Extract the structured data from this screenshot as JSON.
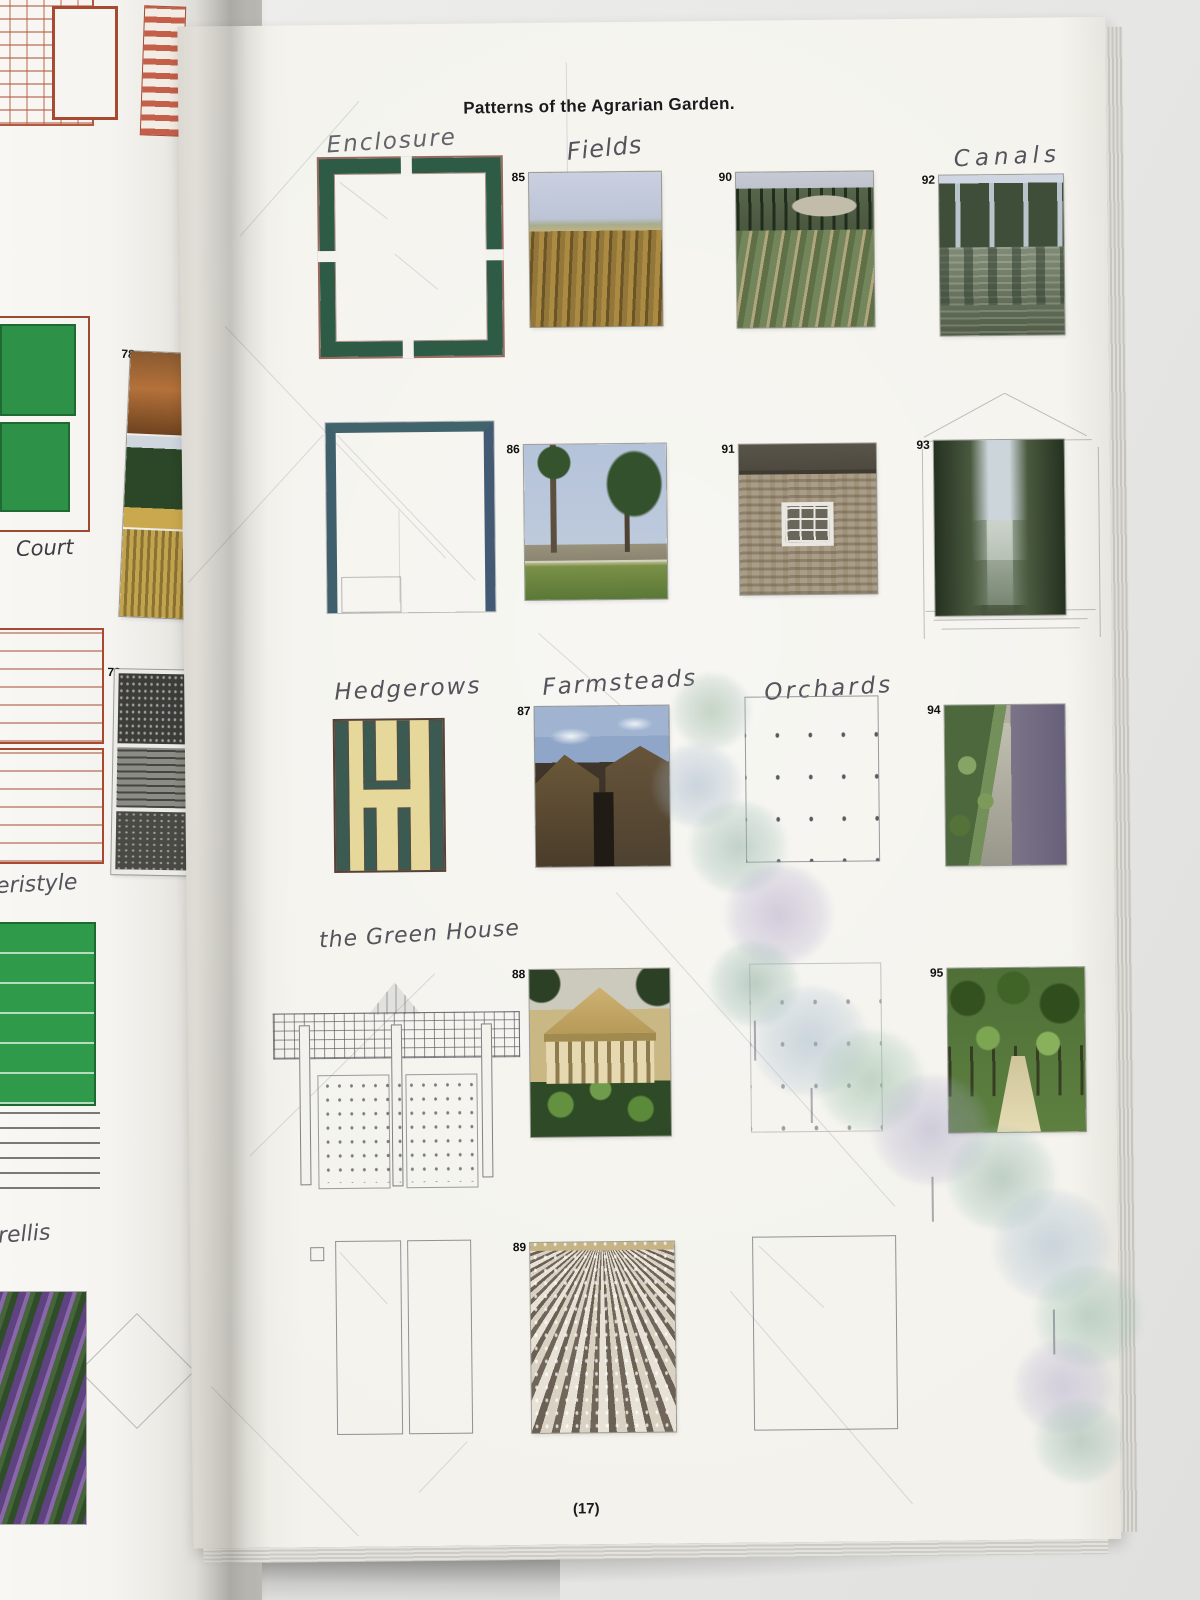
{
  "book": {
    "title": "Patterns of the Agrarian Garden.",
    "page_number": "(17)"
  },
  "left_page": {
    "labels": {
      "court": "Court",
      "peristyle": "eristyle",
      "trellis": "rellis"
    },
    "figures": [
      {
        "number": "78",
        "subject": "farm buildings, trees and wheat field"
      },
      {
        "number": "79",
        "subject": "engraving of trees and farm buildings"
      }
    ]
  },
  "right_page": {
    "section_labels": {
      "enclosure": "Enclosure",
      "fields": "Fields",
      "canals": "Canals",
      "hedgerows": "Hedgerows",
      "farmsteads": "Farmsteads",
      "orchards": "Orchards",
      "greenhouse": "the Green House"
    },
    "photos": [
      {
        "number": "85",
        "subject": "ripe crop field under hazy sky"
      },
      {
        "number": "90",
        "subject": "villa farmland with cypress trees"
      },
      {
        "number": "92",
        "subject": "canal water with tree reflections"
      },
      {
        "number": "86",
        "subject": "young poplars in front of farm fields"
      },
      {
        "number": "91",
        "subject": "stone farmhouse wall with window"
      },
      {
        "number": "93",
        "subject": "tree-lined canal vista"
      },
      {
        "number": "87",
        "subject": "stone farmstead buildings"
      },
      {
        "number": "94",
        "subject": "water channel beside garden wall"
      },
      {
        "number": "88",
        "subject": "classical villa portico behind crops"
      },
      {
        "number": "95",
        "subject": "avenue of orchard trees"
      },
      {
        "number": "89",
        "subject": "ploughed furrows converging to horizon"
      }
    ]
  }
}
